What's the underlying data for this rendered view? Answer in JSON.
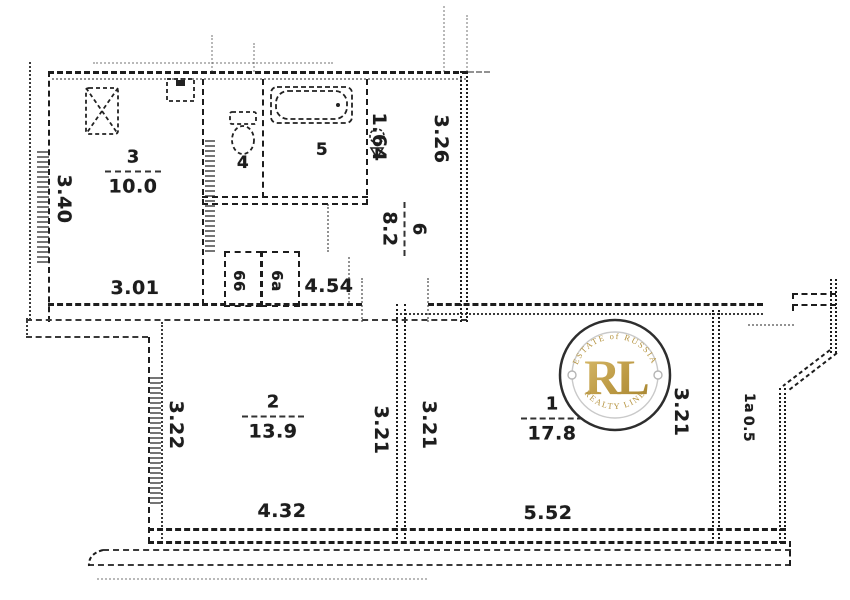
{
  "palette": {
    "paper": "#ffffff",
    "ink": "#1d1d1d",
    "gold": "#b5933f",
    "gold_light": "#d9bc6d",
    "gold_dark": "#a5842f"
  },
  "watermark": {
    "arc_top": "ESTATE of RUSSIA",
    "monogram": "RL",
    "arc_bottom": "REALTY LINE"
  },
  "rooms": {
    "kitchen": {
      "number": "3",
      "area": "10.0"
    },
    "wc": {
      "number": "4"
    },
    "bath": {
      "number": "5"
    },
    "hall": {
      "number": "6",
      "area": "8.2"
    },
    "closet_a": {
      "number": "66"
    },
    "closet_b": {
      "number": "6a"
    },
    "room2": {
      "number": "2",
      "area": "13.9"
    },
    "room1": {
      "number": "1",
      "area": "17.8"
    },
    "loggia": {
      "number": "1a",
      "area": "0.5"
    }
  },
  "dims": {
    "kitchen_side": "3.40",
    "kitchen_bottom": "3.01",
    "corridor_bottom": "4.54",
    "hall_top_left": "1.64",
    "hall_top_right": "3.26",
    "room2_left": "3.22",
    "room2_right": "3.21",
    "room2_bottom": "4.32",
    "room1_left": "3.21",
    "room1_right": "3.21",
    "room1_bottom": "5.52"
  },
  "icons": {
    "stove": "crossed-box",
    "vent": "duct-box",
    "toilet": "tank-and-bowl",
    "bathtub": "rounded-tub",
    "washbasin": "basin-with-spout"
  }
}
